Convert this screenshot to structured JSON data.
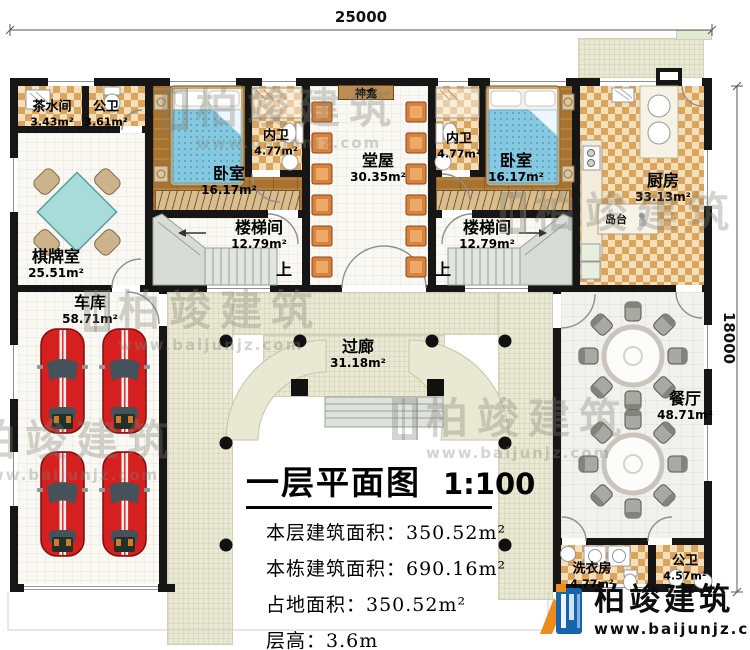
{
  "dimensions": {
    "top": "25000",
    "right": "18000"
  },
  "rooms": {
    "tea": {
      "name": "茶水间",
      "area": "3.43m²"
    },
    "bath_top": {
      "name": "公卫",
      "area": "3.61m²"
    },
    "chess": {
      "name": "棋牌室",
      "area": "25.51m²"
    },
    "bedroom_left": {
      "name": "卧室",
      "area": "16.17m²"
    },
    "inner_bath_left": {
      "name": "内卫",
      "area": "4.77m²"
    },
    "shrine": {
      "name": "神龛"
    },
    "hall": {
      "name": "堂屋",
      "area": "30.35m²"
    },
    "inner_bath_right": {
      "name": "内卫",
      "area": "4.77m²"
    },
    "bedroom_right": {
      "name": "卧室",
      "area": "16.17m²"
    },
    "kitchen": {
      "name": "厨房",
      "area": "33.13m²"
    },
    "island": {
      "name": "岛台"
    },
    "stair_left": {
      "name": "楼梯间",
      "area": "12.79m²",
      "up": "上"
    },
    "stair_right": {
      "name": "楼梯间",
      "area": "12.79m²",
      "up": "上"
    },
    "garage": {
      "name": "车库",
      "area": "58.71m²"
    },
    "corridor": {
      "name": "过廊",
      "area": "31.18m²"
    },
    "dining": {
      "name": "餐厅",
      "area": "48.71m²"
    },
    "laundry": {
      "name": "洗衣房",
      "area": "4.77m²"
    },
    "bath_bottom": {
      "name": "公卫",
      "area": "4.57m²"
    }
  },
  "title_block": {
    "title": "一层平面图",
    "scale": "1:100",
    "stats": [
      "本层建筑面积：350.52m²",
      "本栋建筑面积：690.16m²",
      "占地面积：350.52m²",
      "层高：3.6m"
    ]
  },
  "brand": {
    "name": "柏竣建筑",
    "url": "www.baijunjz.com"
  },
  "watermark": {
    "text": "柏竣建筑",
    "url": "www.baijunjz.com"
  },
  "colors": {
    "wall": "#161616",
    "tile": "#dba45c",
    "wood": "#a9732f",
    "paving": "#e9e8d2",
    "bed": "#85c8e0",
    "car": "#d62020",
    "brand_blue": "#1465ab",
    "brand_orange": "#ef8b1c"
  }
}
